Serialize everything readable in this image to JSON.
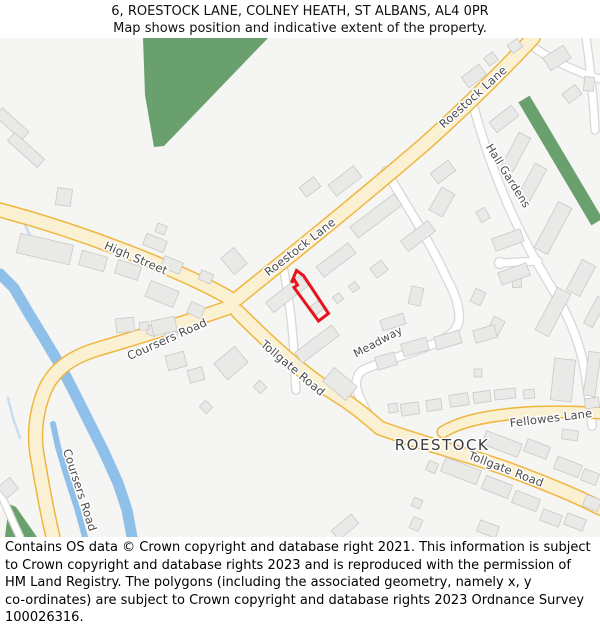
{
  "header": {
    "title": "6, ROESTOCK LANE, COLNEY HEATH, ST ALBANS, AL4 0PR",
    "subtitle": "Map shows position and indicative extent of the property."
  },
  "footer": {
    "text": "Contains OS data © Crown copyright and database right 2021. This information is subject\nto Crown copyright and database rights 2023 and is reproduced with the permission of\nHM Land Registry. The polygons (including the associated geometry, namely x, y\nco-ordinates) are subject to Crown copyright and database rights 2023 Ordnance Survey\n100026316."
  },
  "map": {
    "colors": {
      "land": "#f5f5f3",
      "building": "#e9e9e8",
      "buildingStroke": "#c9c9c7",
      "roadFill": "#faf0d2",
      "roadCasingMajor": "#f0b63f",
      "minorFill": "#ffffff",
      "roadCasingMinor": "#d8d8d6",
      "water": "#8fc0ea",
      "waterLight": "#c6ddf2",
      "green": "#6aa06d",
      "label": "#4b4b4b",
      "plotRed": "#e8131b"
    },
    "greens": [
      {
        "name": "woodland",
        "points": "143,38 268,38 164,146 154,147 145,95"
      },
      {
        "name": "tree-belt",
        "x1": 524,
        "y1": 99,
        "x2": 597,
        "y2": 222,
        "w": 13
      },
      {
        "name": "green-corner",
        "points": "9,504 16,507 37,537 5,537"
      }
    ],
    "water": [
      {
        "name": "river",
        "w": 11,
        "light": false,
        "pts": [
          [
            0,
            274
          ],
          [
            14,
            288
          ],
          [
            28,
            312
          ],
          [
            45,
            340
          ],
          [
            60,
            365
          ],
          [
            73,
            390
          ],
          [
            80,
            404
          ],
          [
            90,
            424
          ],
          [
            104,
            452
          ],
          [
            118,
            483
          ],
          [
            127,
            510
          ],
          [
            132,
            537
          ]
        ]
      },
      {
        "name": "stream-tributary",
        "w": 6,
        "light": false,
        "pts": [
          [
            53,
            424
          ],
          [
            58,
            447
          ],
          [
            67,
            477
          ],
          [
            77,
            508
          ],
          [
            85,
            537
          ]
        ]
      },
      {
        "name": "minor-stream",
        "w": 2.5,
        "light": true,
        "pts": [
          [
            16,
            210
          ],
          [
            24,
            223
          ],
          [
            31,
            237
          ]
        ]
      },
      {
        "name": "minor-stream",
        "w": 2.5,
        "light": true,
        "pts": [
          [
            8,
            398
          ],
          [
            13,
            418
          ],
          [
            20,
            438
          ]
        ]
      }
    ],
    "roads": {
      "minor": [
        {
          "id": "hall-gardens",
          "w": 7.5,
          "d": "M 472,100 C 480,132 492,168 508,205 C 524,242 540,268 556,295 C 572,322 582,350 586,378 C 589,398 591,412 592,426"
        },
        {
          "id": "meadway",
          "w": 7.5,
          "d": "M 374,426 C 368,414 360,400 357,390 C 355,382 357,374 363,370 C 382,361 420,351 440,341 C 452,335 458,328 459,320 C 460,308 455,293 448,281 C 440,263 428,241 415,219 C 404,201 394,184 386,171"
        },
        {
          "id": "estate-road",
          "w": 7,
          "d": "M 283,266 C 289,298 293,330 294,355 C 295,372 295,382 296,390"
        },
        {
          "id": "hall-gardens-spur",
          "w": 7,
          "d": "M 502,263 L 538,261",
          "bulb": [
            500,
            263,
            5
          ]
        },
        {
          "id": "service-road-ne",
          "w": 7,
          "d": "M 536,49 C 556,62 576,72 600,79"
        },
        {
          "id": "service-road-e",
          "w": 7,
          "d": "M 586,38 C 590,62 592,88 594,112 L 595,130"
        },
        {
          "id": "service-road-sw",
          "w": 6,
          "d": "M 0,492 C 6,506 13,522 20,537"
        }
      ],
      "major": [
        {
          "id": "high-street",
          "w": 12.5,
          "d": "M 0,210 C 60,226 120,248 165,267 C 198,281 220,292 234,301"
        },
        {
          "id": "roestock-lane",
          "w": 12.5,
          "d": "M 234,301 C 290,256 345,212 420,148 C 460,113 505,68 533,38"
        },
        {
          "id": "coursers-road",
          "w": 12.5,
          "d": "M 230,307 C 185,323 135,338 98,349 C 68,358 52,372 44,392 C 36,412 33,436 38,460 C 42,484 47,512 53,537"
        },
        {
          "id": "tollgate-road",
          "w": 12.5,
          "d": "M 238,312 C 268,342 300,372 335,394 C 355,406 368,418 380,428 C 420,443 470,455 510,470 C 545,483 575,495 600,508"
        },
        {
          "id": "fellowes-lane",
          "w": 10,
          "d": "M 443,432 C 462,420 495,415 522,413 C 550,411 578,412 600,413"
        }
      ]
    },
    "buildings": [
      [
        12,
        124,
        36,
        11,
        42
      ],
      [
        26,
        150,
        40,
        11,
        42
      ],
      [
        64,
        197,
        15,
        17,
        8
      ],
      [
        45,
        249,
        54,
        20,
        13
      ],
      [
        93,
        261,
        26,
        15,
        16
      ],
      [
        128,
        270,
        24,
        14,
        18
      ],
      [
        155,
        243,
        22,
        12,
        22
      ],
      [
        161,
        229,
        10,
        9,
        22
      ],
      [
        172,
        265,
        20,
        12,
        22
      ],
      [
        206,
        277,
        13,
        10,
        22
      ],
      [
        234,
        261,
        17,
        21,
        -40
      ],
      [
        162,
        294,
        30,
        17,
        22
      ],
      [
        196,
        310,
        15,
        12,
        25
      ],
      [
        152,
        331,
        9,
        9,
        22
      ],
      [
        171,
        335,
        12,
        9,
        22
      ],
      [
        125,
        325,
        18,
        14,
        -5
      ],
      [
        144,
        326,
        9,
        8,
        -5
      ],
      [
        164,
        326,
        24,
        15,
        -12
      ],
      [
        176,
        361,
        19,
        15,
        -15
      ],
      [
        196,
        375,
        15,
        13,
        -15
      ],
      [
        231,
        363,
        27,
        21,
        -40
      ],
      [
        206,
        407,
        10,
        9,
        45
      ],
      [
        260,
        387,
        10,
        9,
        45
      ],
      [
        287,
        294,
        44,
        13,
        -38
      ],
      [
        336,
        260,
        40,
        13,
        -37
      ],
      [
        376,
        216,
        55,
        14,
        -37
      ],
      [
        418,
        236,
        34,
        13,
        -37
      ],
      [
        318,
        307,
        12,
        10,
        -38
      ],
      [
        379,
        269,
        14,
        12,
        -37
      ],
      [
        354,
        287,
        8,
        8,
        -37
      ],
      [
        338,
        298,
        8,
        8,
        -37
      ],
      [
        345,
        181,
        32,
        14,
        -37
      ],
      [
        310,
        187,
        18,
        12,
        -37
      ],
      [
        443,
        172,
        22,
        13,
        -37
      ],
      [
        442,
        202,
        15,
        26,
        30
      ],
      [
        483,
        215,
        10,
        12,
        -30
      ],
      [
        508,
        240,
        30,
        13,
        -20
      ],
      [
        416,
        296,
        12,
        18,
        12
      ],
      [
        478,
        297,
        11,
        14,
        25
      ],
      [
        517,
        283,
        9,
        9,
        0
      ],
      [
        474,
        76,
        22,
        13,
        -37
      ],
      [
        491,
        59,
        11,
        10,
        -37
      ],
      [
        515,
        46,
        12,
        10,
        -37
      ],
      [
        557,
        58,
        24,
        15,
        -32
      ],
      [
        572,
        94,
        16,
        12,
        -37
      ],
      [
        589,
        84,
        10,
        14,
        5
      ],
      [
        504,
        119,
        28,
        13,
        -38
      ],
      [
        516,
        152,
        13,
        38,
        28
      ],
      [
        532,
        183,
        13,
        38,
        28
      ],
      [
        553,
        228,
        15,
        52,
        28
      ],
      [
        581,
        278,
        15,
        34,
        28
      ],
      [
        553,
        312,
        15,
        48,
        28
      ],
      [
        514,
        274,
        30,
        13,
        -20
      ],
      [
        496,
        326,
        12,
        16,
        28
      ],
      [
        595,
        312,
        10,
        30,
        28
      ],
      [
        563,
        380,
        21,
        42,
        6
      ],
      [
        592,
        374,
        12,
        44,
        8
      ],
      [
        393,
        408,
        9,
        9,
        -8
      ],
      [
        410,
        409,
        18,
        12,
        -8
      ],
      [
        434,
        405,
        15,
        11,
        -8
      ],
      [
        459,
        400,
        19,
        12,
        -8
      ],
      [
        482,
        397,
        17,
        11,
        -8
      ],
      [
        505,
        394,
        21,
        10,
        -6
      ],
      [
        529,
        394,
        11,
        9,
        -6
      ],
      [
        570,
        435,
        16,
        10,
        8
      ],
      [
        592,
        403,
        14,
        10,
        -8
      ],
      [
        502,
        444,
        38,
        14,
        21
      ],
      [
        537,
        449,
        24,
        13,
        21
      ],
      [
        568,
        467,
        26,
        13,
        21
      ],
      [
        590,
        477,
        16,
        12,
        21
      ],
      [
        461,
        471,
        38,
        15,
        21
      ],
      [
        497,
        487,
        28,
        14,
        21
      ],
      [
        526,
        501,
        26,
        13,
        21
      ],
      [
        551,
        518,
        20,
        12,
        21
      ],
      [
        575,
        522,
        20,
        12,
        21
      ],
      [
        592,
        503,
        16,
        12,
        21
      ],
      [
        488,
        529,
        20,
        12,
        21
      ],
      [
        432,
        467,
        10,
        10,
        23
      ],
      [
        417,
        503,
        9,
        9,
        23
      ],
      [
        416,
        524,
        10,
        12,
        23
      ],
      [
        345,
        527,
        26,
        12,
        -40
      ],
      [
        340,
        384,
        30,
        18,
        40
      ],
      [
        393,
        322,
        24,
        11,
        -18
      ],
      [
        386,
        361,
        20,
        13,
        -16
      ],
      [
        415,
        347,
        26,
        13,
        -16
      ],
      [
        448,
        340,
        26,
        13,
        -16
      ],
      [
        485,
        334,
        22,
        13,
        -16
      ],
      [
        478,
        373,
        8,
        8,
        0
      ],
      [
        317,
        344,
        46,
        13,
        -37
      ],
      [
        8,
        488,
        16,
        14,
        -40
      ]
    ],
    "plot": {
      "d": "M 296.5,270.5 L 303.5,275.5 L 328.5,313.5 L 318.5,321 L 294,287.5 L 297.5,285 L 294.5,280 L 291.5,282.5 Z",
      "label": "property-boundary"
    },
    "labels": [
      {
        "text": "High Street",
        "x": 136,
        "y": 258,
        "rot": 23,
        "size": 11.5
      },
      {
        "text": "Roestock Lane",
        "x": 300,
        "y": 247,
        "rot": -38,
        "size": 11.5
      },
      {
        "text": "Roestock Lane",
        "x": 473,
        "y": 97,
        "rot": -42,
        "size": 11.5
      },
      {
        "text": "Hall Gardens",
        "x": 508,
        "y": 176,
        "rot": 58,
        "size": 11
      },
      {
        "text": "Coursers Road",
        "x": 167,
        "y": 339,
        "rot": -24,
        "size": 11.5
      },
      {
        "text": "Coursers Road",
        "x": 80,
        "y": 490,
        "rot": 72,
        "size": 11.5
      },
      {
        "text": "Tollgate Road",
        "x": 293,
        "y": 368,
        "rot": 40,
        "size": 11.5
      },
      {
        "text": "Tollgate Road",
        "x": 506,
        "y": 469,
        "rot": 21,
        "size": 11.5
      },
      {
        "text": "Fellowes Lane",
        "x": 551,
        "y": 418,
        "rot": -7,
        "size": 11.5
      },
      {
        "text": "Meadway",
        "x": 378,
        "y": 342,
        "rot": -28,
        "size": 11
      },
      {
        "text": "ROESTOCK",
        "x": 442,
        "y": 445,
        "rot": 0,
        "size": 15,
        "ls": 1.5,
        "color": "#3a3a3a"
      }
    ]
  }
}
